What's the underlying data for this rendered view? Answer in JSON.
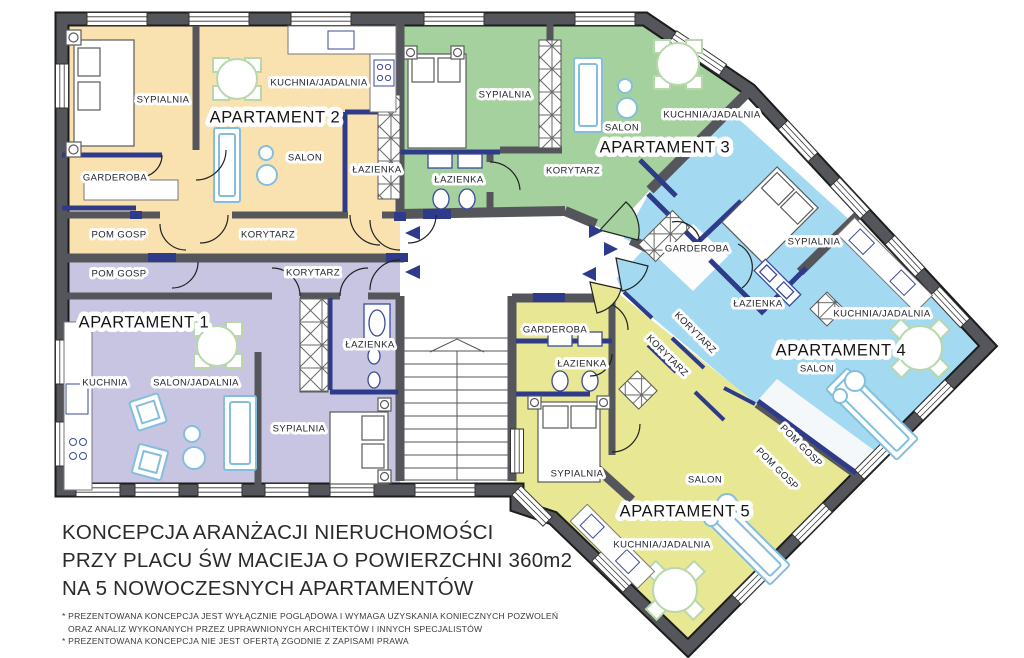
{
  "title_block": {
    "line1": "KONCEPCJA ARANŻACJI NIERUCHOMOŚCI",
    "line2": "PRZY PLACU ŚW MACIEJA O POWIERZCHNI 360m2",
    "line3": "NA 5 NOWOCZESNYCH APARTAMENTÓW"
  },
  "footnotes": {
    "fn1": "* PREZENTOWANA KONCEPCJA JEST WYŁĄCZNIE POGLĄDOWA I WYMAGA UZYSKANIA KONIECZNYCH POZWOLEŃ",
    "fn2": "ORAZ ANALIZ WYKONANYCH PRZEZ UPRAWNIONYCH ARCHITEKTÓW I INNYCH SPECJALISTÓW",
    "fn3": "* PREZENTOWANA KONCEPCJA NIE JEST OFERTĄ ZGODNIE Z ZAPISAMI PRAWA"
  },
  "apartments": [
    {
      "name": "APARTAMENT 1",
      "color": "#c7c5e2",
      "rooms": [
        "POM GOSP",
        "KORYTARZ",
        "KUCHNIA",
        "SALON/JADALNIA",
        "ŁAZIENKA",
        "SYPIALNIA"
      ]
    },
    {
      "name": "APARTAMENT 2",
      "color": "#fae2b0",
      "rooms": [
        "SYPIALNIA",
        "KUCHNIA/JADALNIA",
        "SALON",
        "GARDEROBA",
        "ŁAZIENKA",
        "POM GOSP",
        "KORYTARZ"
      ]
    },
    {
      "name": "APARTAMENT 3",
      "color": "#a5d19e",
      "rooms": [
        "SYPIALNIA",
        "SALON",
        "KUCHNIA/JADALNIA",
        "ŁAZIENKA",
        "KORYTARZ"
      ]
    },
    {
      "name": "APARTAMENT 4",
      "color": "#a3daf2",
      "rooms": [
        "GARDEROBA",
        "SYPIALNIA",
        "ŁAZIENKA",
        "KUCHNIA/JADALNIA",
        "SALON",
        "KORYTARZ",
        "POM GOSP"
      ]
    },
    {
      "name": "APARTAMENT 5",
      "color": "#e8e793",
      "rooms": [
        "GARDEROBA",
        "ŁAZIENKA",
        "SYPIALNIA",
        "KORYTARZ",
        "POM GOSP",
        "SALON",
        "KUCHNIA/JADALNIA"
      ]
    }
  ],
  "palette": {
    "wall": "#55565b",
    "partition_accent": "#2e3a8a",
    "apt1": "#c7c5e2",
    "apt2": "#fae2b0",
    "apt3": "#a5d19e",
    "apt4": "#a3daf2",
    "apt5": "#e8e793",
    "furniture_blue": "#85bedd",
    "furniture_green": "#b8d8ab",
    "fixture_navy": "#3b4a9b"
  },
  "labels": [
    {
      "text": "SYPIALNIA",
      "x": 163,
      "y": 100,
      "rot": 0,
      "type": "room"
    },
    {
      "text": "KUCHNIA/JADALNIA",
      "x": 319,
      "y": 83,
      "rot": 0,
      "type": "room"
    },
    {
      "text": "APARTAMENT 2",
      "x": 275,
      "y": 118,
      "rot": 0,
      "type": "title"
    },
    {
      "text": "SALON",
      "x": 305,
      "y": 158,
      "rot": 0,
      "type": "room"
    },
    {
      "text": "GARDEROBA",
      "x": 115,
      "y": 178,
      "rot": 0,
      "type": "room"
    },
    {
      "text": "ŁAZIENKA",
      "x": 377,
      "y": 170,
      "rot": 0,
      "type": "room"
    },
    {
      "text": "POM GOSP",
      "x": 119,
      "y": 235,
      "rot": 0,
      "type": "room"
    },
    {
      "text": "KORYTARZ",
      "x": 268,
      "y": 235,
      "rot": 0,
      "type": "room"
    },
    {
      "text": "POM GOSP",
      "x": 119,
      "y": 274,
      "rot": 0,
      "type": "room"
    },
    {
      "text": "KORYTARZ",
      "x": 313,
      "y": 273,
      "rot": 0,
      "type": "room"
    },
    {
      "text": "APARTAMENT 1",
      "x": 144,
      "y": 323,
      "rot": 0,
      "type": "title"
    },
    {
      "text": "KUCHNIA",
      "x": 105,
      "y": 383,
      "rot": 0,
      "type": "room"
    },
    {
      "text": "SALON/JADALNIA",
      "x": 196,
      "y": 383,
      "rot": 0,
      "type": "room"
    },
    {
      "text": "ŁAZIENKA",
      "x": 370,
      "y": 345,
      "rot": 0,
      "type": "room"
    },
    {
      "text": "SYPIALNIA",
      "x": 299,
      "y": 429,
      "rot": 0,
      "type": "room"
    },
    {
      "text": "SYPIALNIA",
      "x": 505,
      "y": 95,
      "rot": 0,
      "type": "room"
    },
    {
      "text": "SALON",
      "x": 622,
      "y": 128,
      "rot": 0,
      "type": "room"
    },
    {
      "text": "KUCHNIA/JADALNIA",
      "x": 712,
      "y": 115,
      "rot": 0,
      "type": "room"
    },
    {
      "text": "APARTAMENT 3",
      "x": 665,
      "y": 148,
      "rot": 0,
      "type": "title"
    },
    {
      "text": "ŁAZIENKA",
      "x": 459,
      "y": 180,
      "rot": 0,
      "type": "room"
    },
    {
      "text": "KORYTARZ",
      "x": 573,
      "y": 171,
      "rot": 0,
      "type": "room"
    },
    {
      "text": "GARDEROBA",
      "x": 697,
      "y": 249,
      "rot": 0,
      "type": "room"
    },
    {
      "text": "SYPIALNIA",
      "x": 814,
      "y": 242,
      "rot": 0,
      "type": "room"
    },
    {
      "text": "ŁAZIENKA",
      "x": 758,
      "y": 304,
      "rot": 0,
      "type": "room"
    },
    {
      "text": "KUCHNIA/JADALNIA",
      "x": 882,
      "y": 314,
      "rot": 0,
      "type": "room"
    },
    {
      "text": "APARTAMENT 4",
      "x": 841,
      "y": 351,
      "rot": 0,
      "type": "title"
    },
    {
      "text": "SALON",
      "x": 817,
      "y": 369,
      "rot": 0,
      "type": "room"
    },
    {
      "text": "KORYTARZ",
      "x": 695,
      "y": 333,
      "rot": 45,
      "type": "room"
    },
    {
      "text": "POM GOSP",
      "x": 801,
      "y": 446,
      "rot": 45,
      "type": "room"
    },
    {
      "text": "GARDEROBA",
      "x": 555,
      "y": 330,
      "rot": 0,
      "type": "room"
    },
    {
      "text": "ŁAZIENKA",
      "x": 582,
      "y": 364,
      "rot": 0,
      "type": "room"
    },
    {
      "text": "SYPIALNIA",
      "x": 577,
      "y": 474,
      "rot": 0,
      "type": "room"
    },
    {
      "text": "KORYTARZ",
      "x": 667,
      "y": 356,
      "rot": 45,
      "type": "room"
    },
    {
      "text": "POM GOSP",
      "x": 777,
      "y": 469,
      "rot": 45,
      "type": "room"
    },
    {
      "text": "SALON",
      "x": 705,
      "y": 480,
      "rot": 0,
      "type": "room"
    },
    {
      "text": "APARTAMENT 5",
      "x": 685,
      "y": 512,
      "rot": 0,
      "type": "title"
    },
    {
      "text": "KUCHNIA/JADALNIA",
      "x": 662,
      "y": 545,
      "rot": 0,
      "type": "room"
    }
  ]
}
